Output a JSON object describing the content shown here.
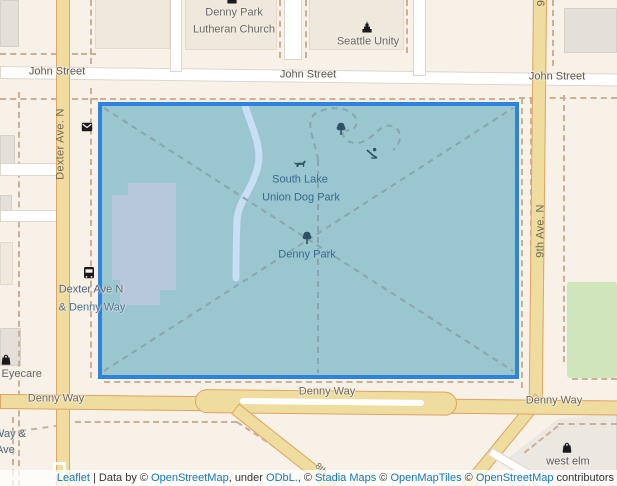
{
  "colors": {
    "background": "#f7f1e8",
    "polygon_fill": "#9ac6d0",
    "polygon_border": "#2f82dd",
    "road_yellow": "#eedd9e",
    "park_label": "#3c688c",
    "attribution_link": "#1577b5"
  },
  "streets": {
    "john_1": "John Street",
    "john_2": "John Street",
    "john_3": "John Street",
    "dexter": "Dexter Ave. N",
    "ninth": "9th Ave. N",
    "ninth_partial": "9",
    "denny_1": "Denny Way",
    "denny_2": "Denny Way",
    "denny_3": "Denny Way",
    "eighth_partial": "8th"
  },
  "places": {
    "church_line1": "Denny Park",
    "church_line2": "Lutheran Church",
    "seattle_unity": "Seattle Unity",
    "dogpark_line1": "South Lake",
    "dogpark_line2": "Union Dog Park",
    "denny_park": "Denny Park",
    "eyecare_partial": "s Eyecare",
    "west_elm": "west elm"
  },
  "transit": {
    "stop1_line1": "Dexter Ave N",
    "stop1_line2": "& Denny Way",
    "stop2_line1": "Way &",
    "stop2_line2": "Ave"
  },
  "attribution": {
    "segments": [
      {
        "text": "Leaflet",
        "link": true
      },
      {
        "text": " | Data by © ",
        "link": false
      },
      {
        "text": "OpenStreetMap",
        "link": true
      },
      {
        "text": ", under ",
        "link": false
      },
      {
        "text": "ODbL.",
        "link": true
      },
      {
        "text": ", © ",
        "link": false
      },
      {
        "text": "Stadia Maps",
        "link": true
      },
      {
        "text": " © ",
        "link": false
      },
      {
        "text": "OpenMapTiles",
        "link": true
      },
      {
        "text": " © ",
        "link": false
      },
      {
        "text": "OpenStreetMap",
        "link": true
      },
      {
        "text": " contributors",
        "link": false
      }
    ]
  }
}
